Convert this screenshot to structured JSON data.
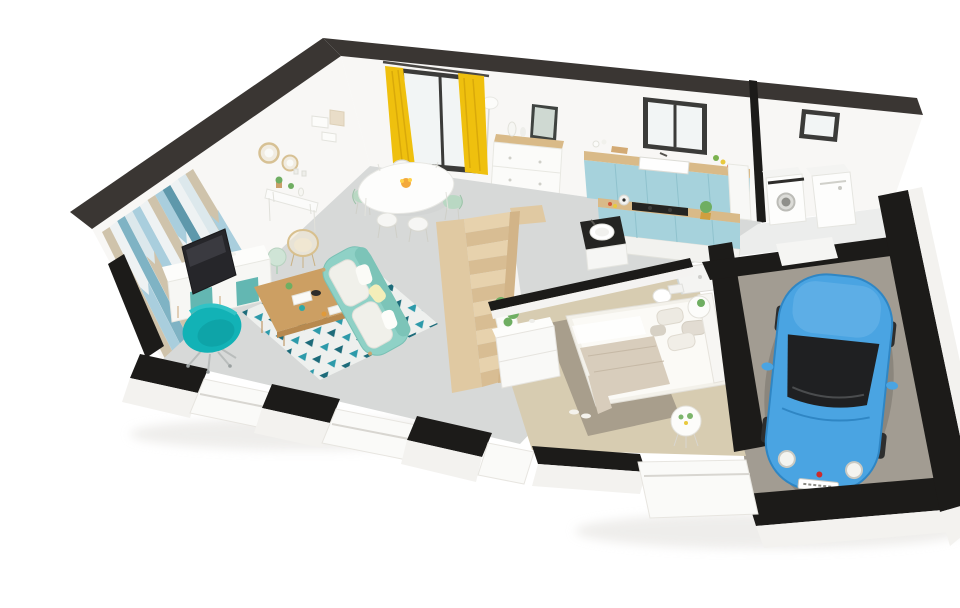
{
  "scene": {
    "description": "3D cutaway dollhouse floor plan of a single-storey home: open living room, dining area and blue kitchen, bathroom, bedroom, wooden staircase, laundry nook and attached garage with a parked blue city car",
    "view": "isometric top-down perspective render",
    "background": "#ffffff"
  },
  "palette": {
    "wall_top": "#3a3633",
    "cut_band": "#1c1b19",
    "wall_face": "#f8f7f5",
    "wall_face_outer": "#f3f2ef",
    "floor_main": "#d7d9d8",
    "floor_bedroom": "#d7ccb1",
    "floor_garage": "#a29c92",
    "floor_laundry": "#ecedec",
    "accent_wall_stripes": [
      "#cfc3ab",
      "#eef2f3",
      "#7fb3c4",
      "#a9cedd",
      "#dce8ec",
      "#5e98ab"
    ],
    "counter_wood": "#d9ba88",
    "cabinet_blue": "#a6d2dc",
    "stairs_wood": "#e0c9a2",
    "tread_light": "#e7d2ad",
    "tread_dark": "#d8bd93",
    "sofa_teal": "#8fd1c6",
    "armchair_teal": "#12b2b6",
    "rug_base": "#eef0ee",
    "rug_teal": "#2d9aaa",
    "rug_dark_teal": "#1d6b7a",
    "curtain_yellow": "#efc00e",
    "door_frame": "#3b3b39",
    "glass": "#f2f5f5",
    "car_blue": "#4aa4e2",
    "car_glass": "#1f2022",
    "mint_green": "#b9d8c3",
    "bed_linen": "#fbfaf6",
    "throw_beige": "#d8cdbc",
    "bedroom_rug": "#a89e8c",
    "wood_table": "#cc9f63",
    "plant_green": "#6fae62",
    "appliance_white": "#fdfdfc",
    "cooktop_black": "#242422",
    "fruit_orange": "#f3a93c"
  },
  "rooms": [
    {
      "id": "living-room",
      "label": "Living room",
      "items": [
        "chevron accent wall",
        "round wicker mirrors",
        "wall shelves",
        "TV",
        "white sideboard with teal doors",
        "teal swivel armchair",
        "light-teal sofa with cushions",
        "wood coffee table",
        "triangle-pattern rug",
        "rattan chair",
        "sage side table"
      ]
    },
    {
      "id": "dining-area",
      "label": "Dining area",
      "items": [
        "oval white table",
        "fruit bowl",
        "six chairs in white and mint",
        "yellow curtains",
        "dark-framed sliding glass door",
        "console table with plants",
        "floor lamp"
      ]
    },
    {
      "id": "kitchen",
      "label": "Kitchen",
      "items": [
        "blue wall cabinets with wood counter",
        "inset white sink",
        "window",
        "blue island with black cooktop",
        "cooking pot",
        "cactus in gold pot",
        "tall white cabinet",
        "entry dresser with mirror"
      ]
    },
    {
      "id": "bathroom",
      "label": "Bathroom",
      "items": [
        "vanity with round basin on dark counter",
        "walk-in shower tray",
        "toilet"
      ]
    },
    {
      "id": "bedroom",
      "label": "Bedroom",
      "items": [
        "double bed with beige throw",
        "pillows",
        "taupe rug",
        "slippers",
        "white dresser",
        "two round side tables",
        "potted plants"
      ]
    },
    {
      "id": "stair-hall",
      "label": "Stair hall",
      "items": [
        "wooden staircase",
        "stair-side planter with green plants"
      ]
    },
    {
      "id": "laundry-nook",
      "label": "Laundry nook",
      "items": [
        "washing machine with porthole door",
        "dryer",
        "small window"
      ]
    },
    {
      "id": "garage",
      "label": "Garage",
      "items": [
        "blue compact city car facing forward",
        "concrete floor",
        "dark cut walls"
      ]
    }
  ]
}
